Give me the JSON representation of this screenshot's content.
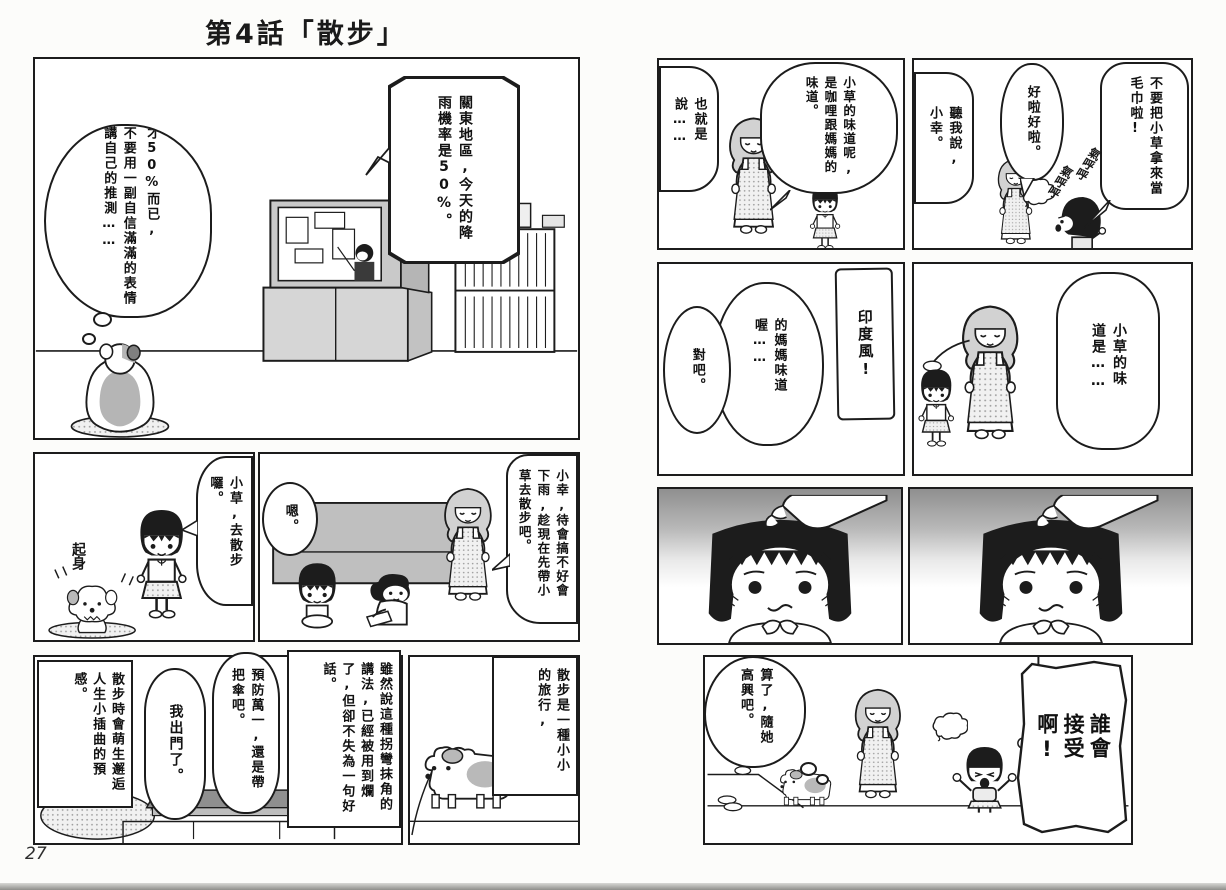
{
  "comic": {
    "title": "第4話「散步」",
    "page_number": "27"
  },
  "left_page": {
    "tv_panel": {
      "tv_bubble": "關東地區,今天的降雨機率是50%。",
      "dog_thought_1": "才50%而已,",
      "dog_thought_2": "不要用一副自信滿滿的表情講自己的推測……"
    },
    "invite_panel": {
      "girl_bubble": "小草,去散步囉。",
      "sfx_get_up": "起身"
    },
    "advice_panel": {
      "mom_bubble": "小幸,待會搞不好會下雨,趁現在先帶小草去散步吧。",
      "girl_bubble": "嗯。"
    },
    "departure_panel": {
      "caption_premonition": "散步時會萌生邂逅人生小插曲的預感。",
      "girl_bubble": "我出門了。",
      "mom_bubble": "預防萬一,還是帶把傘吧。",
      "caption_saying": "雖然說這種拐彎抹角的講法,已經被用到爛了,但卻不失為一句好話。"
    },
    "journey_panel": {
      "caption_journey": "散步是一種小小的旅行,"
    }
  },
  "right_page": {
    "towel_panel": {
      "girl_bubble": "不要把小草拿來當毛巾啦!",
      "mom_bubble_ok": "好啦好啦。",
      "mom_bubble_listen": "聽我說,小幸。",
      "sfx_fuming_1": "氣呼呼",
      "sfx_fuming_2": "氣呼呼"
    },
    "curry_panel": {
      "mom_bubble_smell": "小草的味道呢,是咖哩跟媽媽的味道。",
      "mom_bubble_so": "也就是說……"
    },
    "smell_panel": {
      "mom_bubble": "小草的味道是……"
    },
    "india_panel": {
      "mom_bubble_india": "印度風!",
      "mom_bubble_mom_smell": "的媽媽味道喔……",
      "mom_bubble_right": "對吧。"
    },
    "ending_panel": {
      "girl_shout_bubble": "誰會接受啊!",
      "mom_thought_bubble": "算了,隨她高興吧。"
    }
  }
}
